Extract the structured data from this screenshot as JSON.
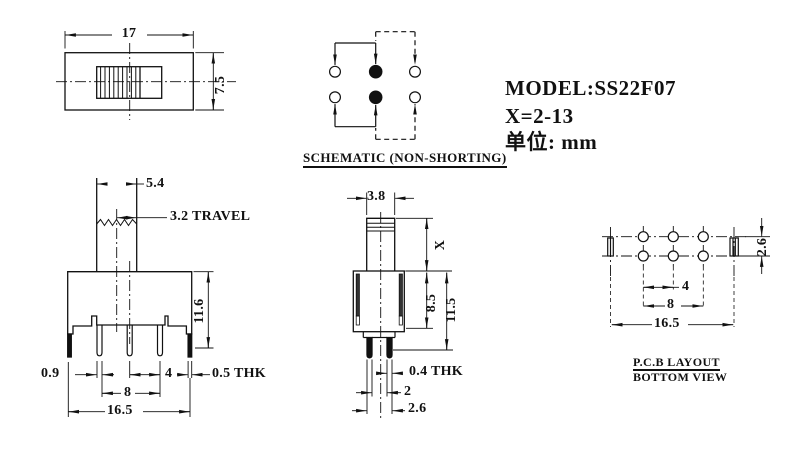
{
  "info": {
    "model": "MODEL:SS22F07",
    "x_range": "X=2-13",
    "units": "单位: mm"
  },
  "top_view": {
    "width": "17",
    "height": "7.5"
  },
  "schematic": {
    "caption": "SCHEMATIC (NON-SHORTING)"
  },
  "front_view": {
    "knob_width": "5.4",
    "travel": "3.2 TRAVEL",
    "height": "11.6",
    "pin_width": "0.9",
    "pin_pitch": "4",
    "tab_thickness": "0.5 THK",
    "pin_span": "8",
    "body_width": "16.5"
  },
  "side_view": {
    "knob_depth": "3.8",
    "knob_height": "X",
    "body_height": "8.5",
    "total_height": "11.5",
    "pin_thickness": "0.4 THK",
    "pin_gap": "2",
    "pin_row_span": "2.6"
  },
  "pcb": {
    "caption_line1": "P.C.B LAYOUT",
    "caption_line2": "BOTTOM VIEW",
    "row_pitch": "2.6",
    "hole_pitch": "4",
    "hole_span": "8",
    "overall_width": "16.5"
  },
  "colors": {
    "ink": "#111111",
    "background": "#ffffff"
  }
}
